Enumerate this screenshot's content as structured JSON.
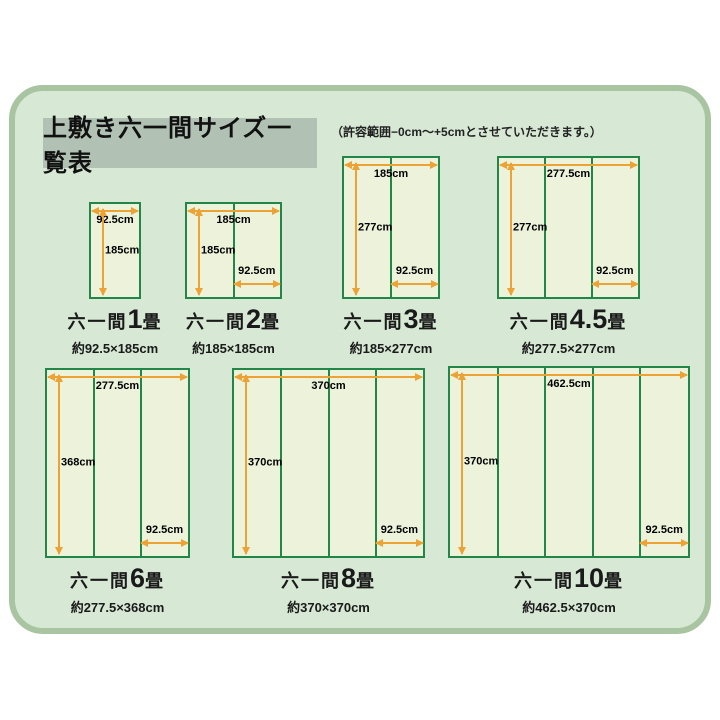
{
  "page": {
    "title": "上敷き六一間サイズ一覧表",
    "note": "（許容範囲−0cm〜+5cmとさせていただきます。）"
  },
  "colors": {
    "mat_border_green": "#218648",
    "mat_fill": "#edf3da",
    "dimension_arrow_orange": "#eca235",
    "panel_background": "#d7e9d5",
    "panel_border": "#a8c4a1",
    "title_box_background": "#b1c2b4"
  },
  "mats": [
    {
      "name_prefix": "六一間",
      "name_num": "1",
      "name_suffix": "畳",
      "size_label": "約92.5×185cm",
      "width_label": "92.5cm",
      "height_label": "185cm",
      "panel_width_label": "",
      "panels": 1
    },
    {
      "name_prefix": "六一間",
      "name_num": "2",
      "name_suffix": "畳",
      "size_label": "約185×185cm",
      "width_label": "185cm",
      "height_label": "185cm",
      "panel_width_label": "92.5cm",
      "panels": 2
    },
    {
      "name_prefix": "六一間",
      "name_num": "3",
      "name_suffix": "畳",
      "size_label": "約185×277cm",
      "width_label": "185cm",
      "height_label": "277cm",
      "panel_width_label": "92.5cm",
      "panels": 2
    },
    {
      "name_prefix": "六一間",
      "name_num": "4.5",
      "name_suffix": "畳",
      "size_label": "約277.5×277cm",
      "width_label": "277.5cm",
      "height_label": "277cm",
      "panel_width_label": "92.5cm",
      "panels": 3
    },
    {
      "name_prefix": "六一間",
      "name_num": "6",
      "name_suffix": "畳",
      "size_label": "約277.5×368cm",
      "width_label": "277.5cm",
      "height_label": "368cm",
      "panel_width_label": "92.5cm",
      "panels": 3
    },
    {
      "name_prefix": "六一間",
      "name_num": "8",
      "name_suffix": "畳",
      "size_label": "約370×370cm",
      "width_label": "370cm",
      "height_label": "370cm",
      "panel_width_label": "92.5cm",
      "panels": 4
    },
    {
      "name_prefix": "六一間",
      "name_num": "10",
      "name_suffix": "畳",
      "size_label": "約462.5×370cm",
      "width_label": "462.5cm",
      "height_label": "370cm",
      "panel_width_label": "92.5cm",
      "panels": 5
    }
  ]
}
